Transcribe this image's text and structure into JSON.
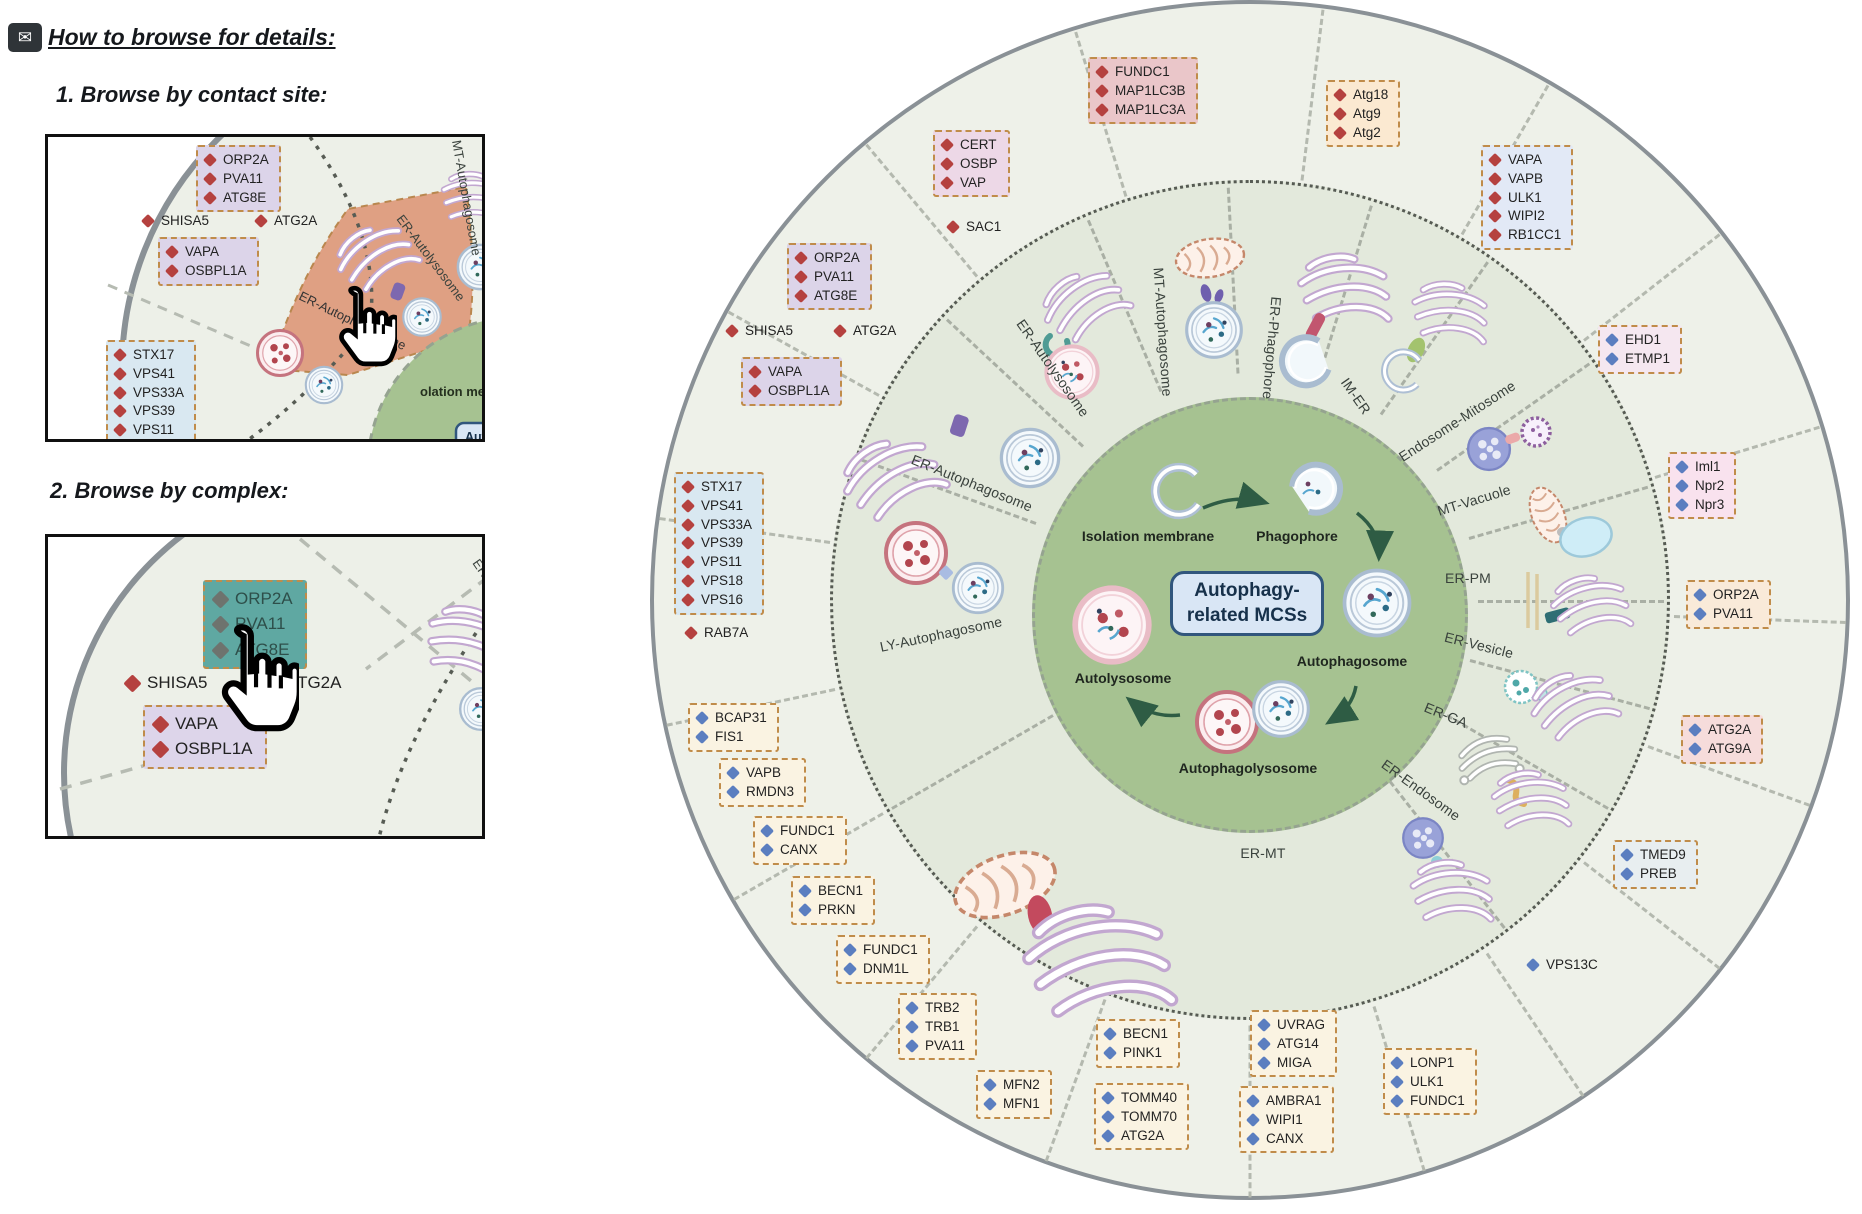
{
  "instructions": {
    "title": "How to browse for details:",
    "step1_heading": "1. Browse by contact site:",
    "step2_heading": "2. Browse by complex:",
    "panel1": {
      "boxes": [
        {
          "id": "orp2a",
          "items": [
            "ORP2A",
            "PVA11",
            "ATG8E"
          ],
          "diamond": "red",
          "bg": "#dcd4e9"
        },
        {
          "id": "vapa",
          "items": [
            "VAPA",
            "OSBPL1A"
          ],
          "diamond": "red",
          "bg": "#dcd4e9"
        },
        {
          "id": "stx17",
          "items": [
            "STX17",
            "VPS41",
            "VPS33A",
            "VPS39",
            "VPS11",
            "VPS18"
          ],
          "diamond": "red",
          "bg": "#d9e8f1"
        }
      ],
      "shisa5": "SHISA5",
      "atg2a": "ATG2A",
      "wedge_label": "ER-Autophagosome",
      "autolysosome_label": "ER-Autolysosome",
      "mt_label": "MT-Autophagosome",
      "membrane_fragment": "olation membrane",
      "badge_fragment": "Aut",
      "wedge_color": "#dfa083"
    },
    "panel2": {
      "highlight_box": {
        "id": "orp2a-highlight",
        "items": [
          "ORP2A",
          "PVA11",
          "ATG8E"
        ],
        "diamond": "gray",
        "bg": "#5fa8a2"
      },
      "vapa_box": {
        "id": "vapa",
        "items": [
          "VAPA",
          "OSBPL1A"
        ],
        "diamond": "red",
        "bg": "#ddd5ea"
      },
      "shisa5": "SHISA5",
      "atg2a": "ATG2A",
      "er_fragment": "ER-Autoly"
    }
  },
  "wheel": {
    "badge_line1": "Autophagy-",
    "badge_line2": "related MCSs",
    "stages": {
      "isolation": "Isolation membrane",
      "phagophore": "Phagophore",
      "autophagosome": "Autophagosome",
      "autophagolysosome": "Autophagolysosome",
      "autolysosome": "Autolysosome"
    },
    "sectors": [
      "ER-Autophagosome",
      "ER-Autolysosome",
      "MT-Autophagosome",
      "ER-Phagophore",
      "IM-ER",
      "Endosome-Mitosome",
      "MT-Vacuole",
      "ER-PM",
      "ER-Vesicle",
      "ER-GA",
      "ER-Endosome",
      "ER-MT",
      "LY-Autophagosome"
    ],
    "boxes": [
      {
        "id": "orp2a-left",
        "items": [
          "ORP2A",
          "PVA11",
          "ATG8E"
        ],
        "diamond": "red",
        "bg": "#dcd4e9"
      },
      {
        "id": "vapa-osbpl1a",
        "items": [
          "VAPA",
          "OSBPL1A"
        ],
        "diamond": "red",
        "bg": "#dcd4e9"
      },
      {
        "id": "cert-osbp-vap",
        "items": [
          "CERT",
          "OSBP",
          "VAP"
        ],
        "diamond": "red",
        "bg": "#edd8e7"
      },
      {
        "id": "fundc1-map1lc3",
        "items": [
          "FUNDC1",
          "MAP1LC3B",
          "MAP1LC3A"
        ],
        "diamond": "red",
        "bg": "#eac6c9"
      },
      {
        "id": "atg18-atg9-atg2",
        "items": [
          "Atg18",
          "Atg9",
          "Atg2"
        ],
        "diamond": "red",
        "bg": "#fbe9d1"
      },
      {
        "id": "vapa-vapb-ulk1-wipi2-rb1cc1",
        "items": [
          "VAPA",
          "VAPB",
          "ULK1",
          "WIPI2",
          "RB1CC1"
        ],
        "diamond": "red",
        "bg": "#e2e9f6"
      },
      {
        "id": "ehd1-etmp1",
        "items": [
          "EHD1",
          "ETMP1"
        ],
        "diamond": "blue",
        "bg": "#f5e7f0"
      },
      {
        "id": "iml1-npr2-npr3",
        "items": [
          "Iml1",
          "Npr2",
          "Npr3"
        ],
        "diamond": "blue",
        "bg": "#f9e2ee"
      },
      {
        "id": "orp2a-pva11",
        "items": [
          "ORP2A",
          "PVA11"
        ],
        "diamond": "blue",
        "bg": "#f9ead9"
      },
      {
        "id": "atg2a-atg9a",
        "items": [
          "ATG2A",
          "ATG9A"
        ],
        "diamond": "blue",
        "bg": "#f6dcdb"
      },
      {
        "id": "tmed9-preb",
        "items": [
          "TMED9",
          "PREB"
        ],
        "diamond": "blue",
        "bg": "#e8eef0"
      },
      {
        "id": "lonp1-ulk1-fundc1",
        "items": [
          "LONP1",
          "ULK1",
          "FUNDC1"
        ],
        "diamond": "blue",
        "bg": "#faf3e2"
      },
      {
        "id": "uvrag-atg14-miga",
        "items": [
          "UVRAG",
          "ATG14",
          "MIGA"
        ],
        "diamond": "blue",
        "bg": "#faf3e2"
      },
      {
        "id": "ambra1-wipi1-canx",
        "items": [
          "AMBRA1",
          "WIPI1",
          "CANX"
        ],
        "diamond": "blue",
        "bg": "#faf3e2"
      },
      {
        "id": "becn1-pink1",
        "items": [
          "BECN1",
          "PINK1"
        ],
        "diamond": "blue",
        "bg": "#faf3e2"
      },
      {
        "id": "tomm40-tomm70-atg2a",
        "items": [
          "TOMM40",
          "TOMM70",
          "ATG2A"
        ],
        "diamond": "blue",
        "bg": "#faf3e2"
      },
      {
        "id": "mfn2-mfn1",
        "items": [
          "MFN2",
          "MFN1"
        ],
        "diamond": "blue",
        "bg": "#faf3e2"
      },
      {
        "id": "trb2-trb1-pva11",
        "items": [
          "TRB2",
          "TRB1",
          "PVA11"
        ],
        "diamond": "blue",
        "bg": "#faf3e2"
      },
      {
        "id": "fundc1-dnm1l",
        "items": [
          "FUNDC1",
          "DNM1L"
        ],
        "diamond": "blue",
        "bg": "#faf3e2"
      },
      {
        "id": "becn1-prkn",
        "items": [
          "BECN1",
          "PRKN"
        ],
        "diamond": "blue",
        "bg": "#faf3e2"
      },
      {
        "id": "fundc1-canx",
        "items": [
          "FUNDC1",
          "CANX"
        ],
        "diamond": "blue",
        "bg": "#faf3e2"
      },
      {
        "id": "vapb-rmdn3",
        "items": [
          "VAPB",
          "RMDN3"
        ],
        "diamond": "blue",
        "bg": "#faf3e2"
      },
      {
        "id": "bcap31-fis1",
        "items": [
          "BCAP31",
          "FIS1"
        ],
        "diamond": "blue",
        "bg": "#faf3e2"
      },
      {
        "id": "stx17-vps-complex",
        "items": [
          "STX17",
          "VPS41",
          "VPS33A",
          "VPS39",
          "VPS11",
          "VPS18",
          "VPS16"
        ],
        "diamond": "red",
        "bg": "#d9e8f1"
      }
    ],
    "loose": [
      {
        "label": "SHISA5",
        "diamond": "red"
      },
      {
        "label": "ATG2A",
        "diamond": "red"
      },
      {
        "label": "SAC1",
        "diamond": "red"
      },
      {
        "label": "RAB7A",
        "diamond": "red"
      },
      {
        "label": "VPS13C",
        "diamond": "blue"
      }
    ],
    "colors": {
      "red_diamond": "#b5413f",
      "blue_diamond": "#5b7ec0",
      "gray_diamond": "#6e736e",
      "box_border": "#c08c4a",
      "wedge_highlight": "#dfa083",
      "complex_highlight": "#5fa8a2",
      "center_green": "#a6c291",
      "badge_bg": "#d9e6f5",
      "badge_border": "#31567d"
    }
  }
}
